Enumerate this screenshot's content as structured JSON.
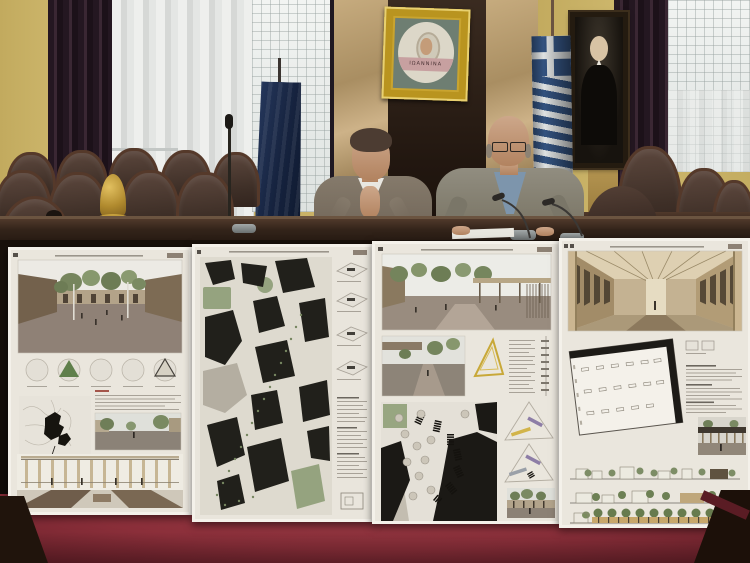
{
  "scene": {
    "description": "Press conference in the Ioannina municipal council chamber: two officials seated at a dark wooden dais beneath a gold-framed city emblem mosaic, with four architectural competition presentation boards propped against the desk and a red carpet in the foreground"
  },
  "emblem": {
    "text": "ΙΩΑΝΝΙΝΑ",
    "label": "Gold-framed mosaic emblem with saint figure"
  },
  "people": [
    {
      "id": "official-left",
      "label": "Official in brown tweed jacket and white shirt, hands clasped in front of his face"
    },
    {
      "id": "official-right",
      "label": "Bald official with glasses, grey tweed jacket and blue shirt, reading papers at a microphone"
    }
  ],
  "flags": [
    {
      "id": "flag-left",
      "label": "Dark blue flag hanging from a pole"
    },
    {
      "id": "flag-right",
      "label": "Greek flag (blue and white stripes with cross)"
    }
  ],
  "portrait": {
    "label": "Framed dark portrait painting of a man in formal dress"
  },
  "furniture": {
    "chairs_label": "Dark leather council chairs with wooden frames",
    "bell_label": "Brass session bell on the bench",
    "desk_label": "Dark wooden council dais desk",
    "carpet_label": "Red chamber carpet"
  },
  "boards": [
    {
      "id": "board-1",
      "label": "Competition board 1: plaza perspective render, five concept diagrams, site sketch with black figure plan, street render, colonnade elevation"
    },
    {
      "id": "board-2",
      "label": "Competition board 2: large black figure-ground city plan with green spaces and annotation column of axonometric diagrams"
    },
    {
      "id": "board-3",
      "label": "Competition board 3: plaza renders with canopy, yellow triangle diagram, black figure-ground site plan with kiosk rows, colored phasing diagrams, photo inset"
    },
    {
      "id": "board-4",
      "label": "Competition board 4: long arcade interior perspective, rotated floor plan with black edge, text column, render inset, three landscape elevations"
    }
  ],
  "palette": {
    "wall_yellow": "#c9b267",
    "curtain_purple": "#2a1b26",
    "carpet_red": "#8d303a",
    "desk_wood": "#241711",
    "board_background": "#eae6dd",
    "gold_frame": "#c9a42f",
    "greek_flag_blue": "#33527f",
    "leather_brown": "#4a3831",
    "marble_tan": "#b99a6b"
  }
}
